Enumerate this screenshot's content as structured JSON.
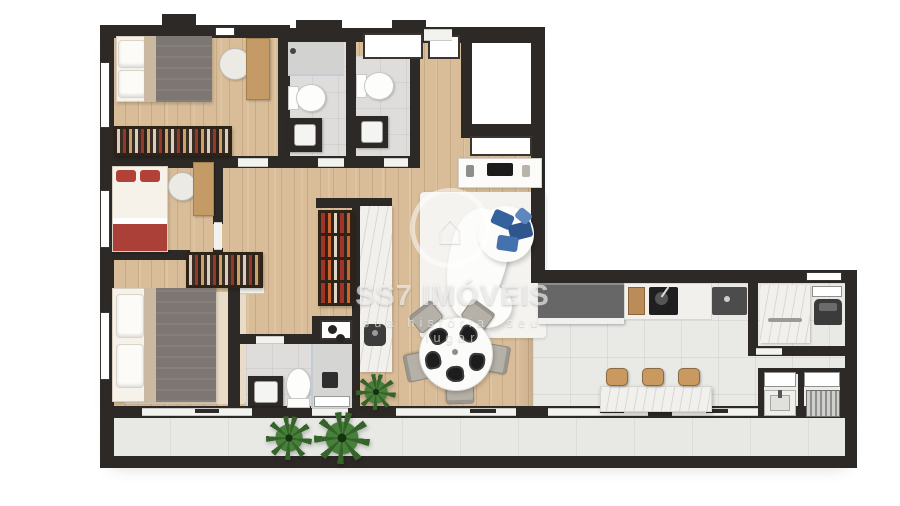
{
  "watermark": {
    "brand": "SS7 IMÓVEIS",
    "tagline": "sua história, seu lugar",
    "logo_icon": "house-in-circle-icon",
    "logo_glyph": "⌂"
  },
  "palette": {
    "wall": "#2d2927",
    "wood": "#d9bd99",
    "tile": "#e9e9e6",
    "bath_tile": "#dedddb",
    "marble": "#f2f0ec",
    "rug": "#f4f3f0",
    "sofa_cushion_blue": "#35619c",
    "bed_blanket_gray": "#7d7672",
    "bed_accent_red": "#ab4038",
    "plant_green": "#356329",
    "counter_dark": "#676767"
  }
}
